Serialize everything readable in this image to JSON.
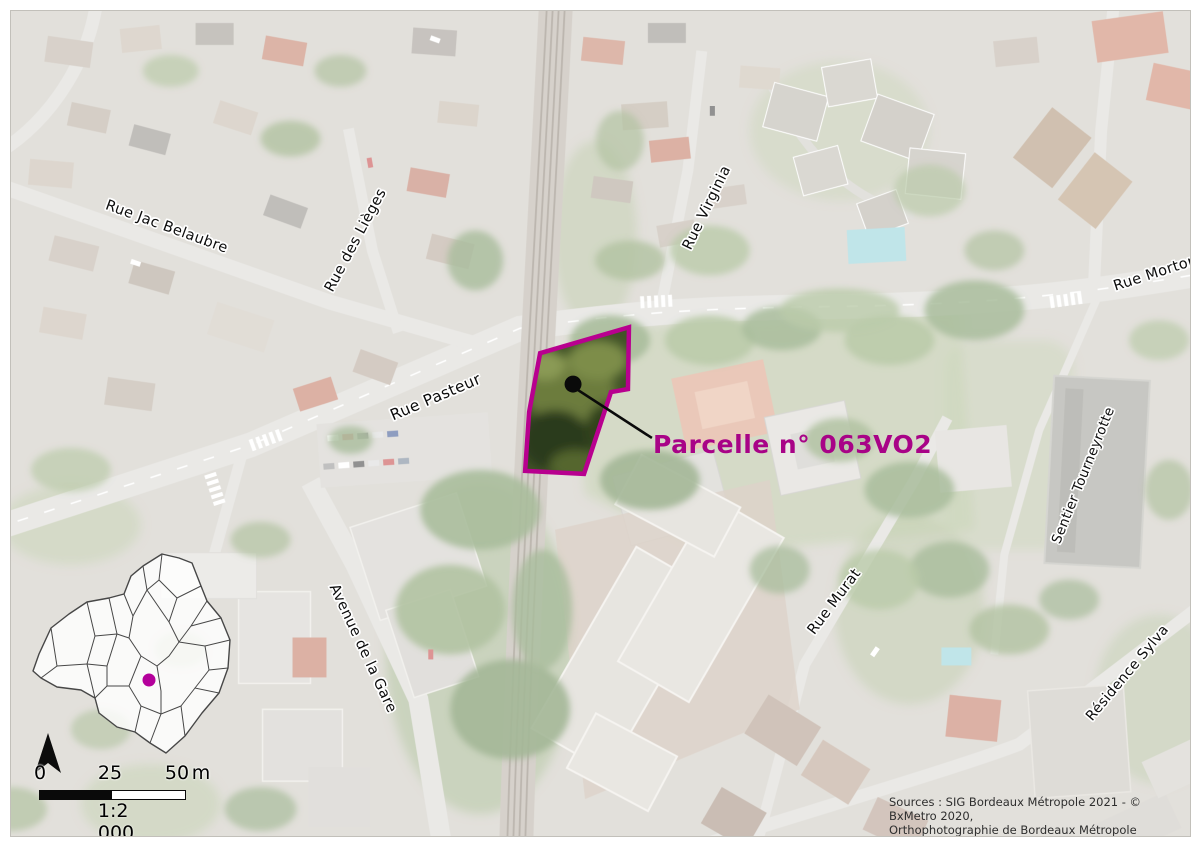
{
  "map": {
    "parcel_label": "Parcelle n° 063VO2",
    "streets": [
      {
        "name": "Rue Jac Belaubre"
      },
      {
        "name": "Rue des Lièges"
      },
      {
        "name": "Rue Pasteur"
      },
      {
        "name": "Rue Virginia"
      },
      {
        "name": "Rue Morton"
      },
      {
        "name": "Sentier Tourneyrotte"
      },
      {
        "name": "Rue Murat"
      },
      {
        "name": "Avenue de la Gare"
      },
      {
        "name": "Résidence Sylva"
      }
    ],
    "scale_bar": {
      "tick0": "0",
      "tick25": "25",
      "tick50": "50",
      "unit": "m",
      "ratio": "1:2 000"
    },
    "sources_line1": "Sources : SIG Bordeaux Métropole 2021 - © BxMetro 2020,",
    "sources_line2": "Orthophotographie de Bordeaux Métropole",
    "colors": {
      "parcel_outline": "#b8008f",
      "parcel_text": "#a80387",
      "locator_dot": "#b4009b"
    }
  }
}
